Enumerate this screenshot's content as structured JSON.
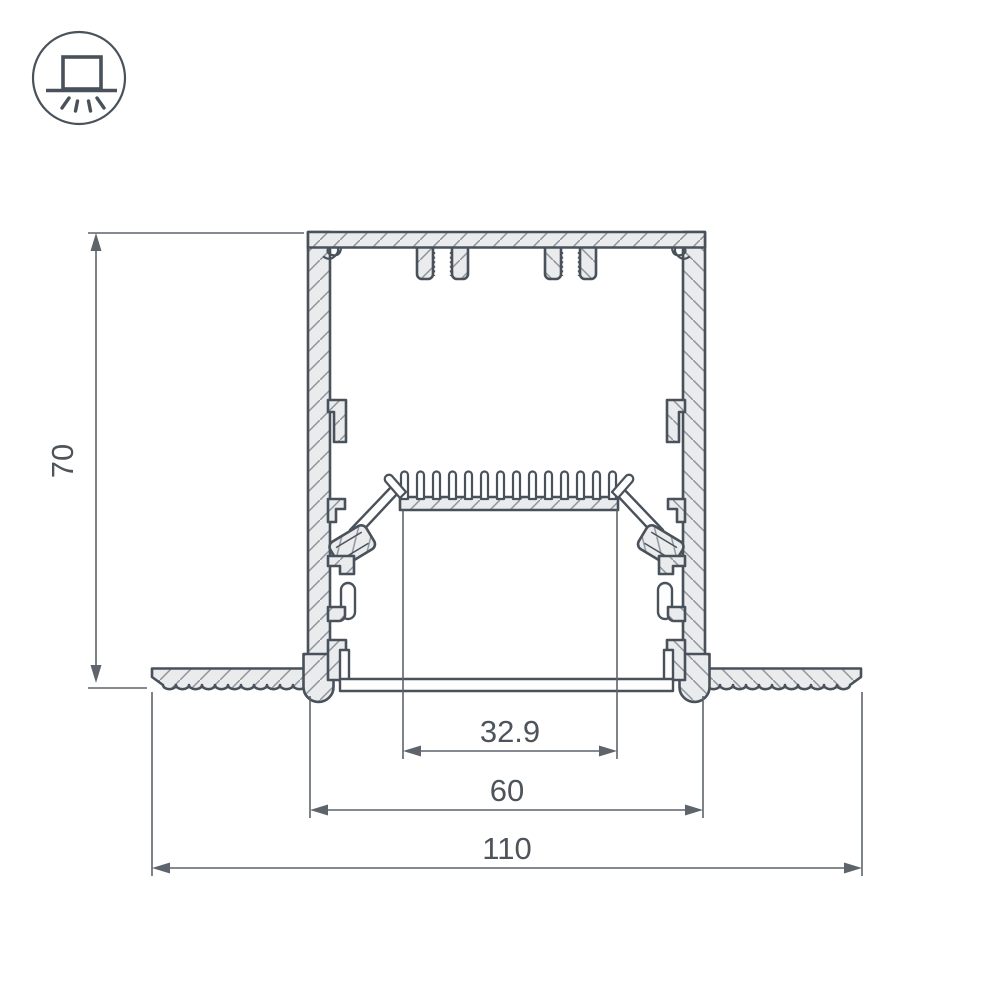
{
  "background": "#ffffff",
  "icon": {
    "name": "recessed-light-icon"
  },
  "drawing": {
    "type": "technical cross-section of recessed aluminium LED profile",
    "dimensions": {
      "height": "70",
      "window_width": "32.9",
      "body_width": "60",
      "overall_width": "110"
    }
  },
  "colors": {
    "outline": "#49515a",
    "fill": "#e9ebed",
    "hatch": "#8d949b",
    "dim": "#5d646b",
    "text": "#4d545b",
    "bg": "#ffffff"
  }
}
